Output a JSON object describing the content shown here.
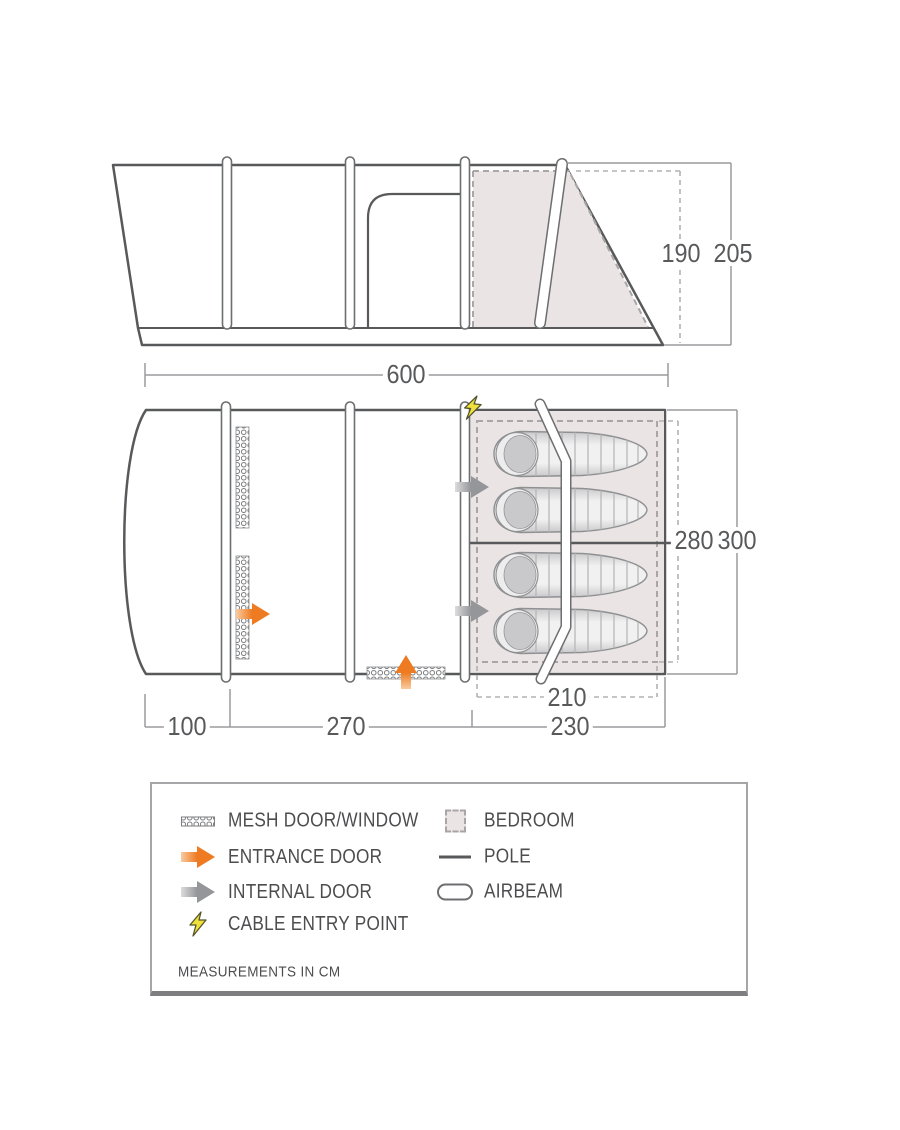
{
  "dims": {
    "length": "600",
    "height_inner": "190",
    "height_outer": "205",
    "width_inner": "280",
    "width_outer": "300",
    "bedroom_inner_length": "210",
    "porch_length": "100",
    "living_length": "270",
    "bedroom_outer_length": "230"
  },
  "legend": {
    "items_left": [
      {
        "icon": "mesh-door-window-icon",
        "label": "MESH DOOR/WINDOW"
      },
      {
        "icon": "entrance-door-arrow-icon",
        "label": "ENTRANCE DOOR"
      },
      {
        "icon": "internal-door-arrow-icon",
        "label": "INTERNAL DOOR"
      },
      {
        "icon": "cable-entry-point-icon",
        "label": "CABLE ENTRY POINT"
      }
    ],
    "items_right": [
      {
        "icon": "bedroom-swatch-icon",
        "label": "BEDROOM"
      },
      {
        "icon": "pole-icon",
        "label": "POLE"
      },
      {
        "icon": "airbeam-icon",
        "label": "AIRBEAM"
      }
    ],
    "footer": "MEASUREMENTS IN CM"
  },
  "colors": {
    "line": "#58595b",
    "beam_outline": "#6d6e70",
    "dimension_line": "#9b9b9d",
    "bedroom_fill": "#eae5e4",
    "dashed_border": "#aaa6a6",
    "entrance_orange": "#ee7b22",
    "internal_gray": "#95969a",
    "cable_yellow": "#f0e23c"
  }
}
